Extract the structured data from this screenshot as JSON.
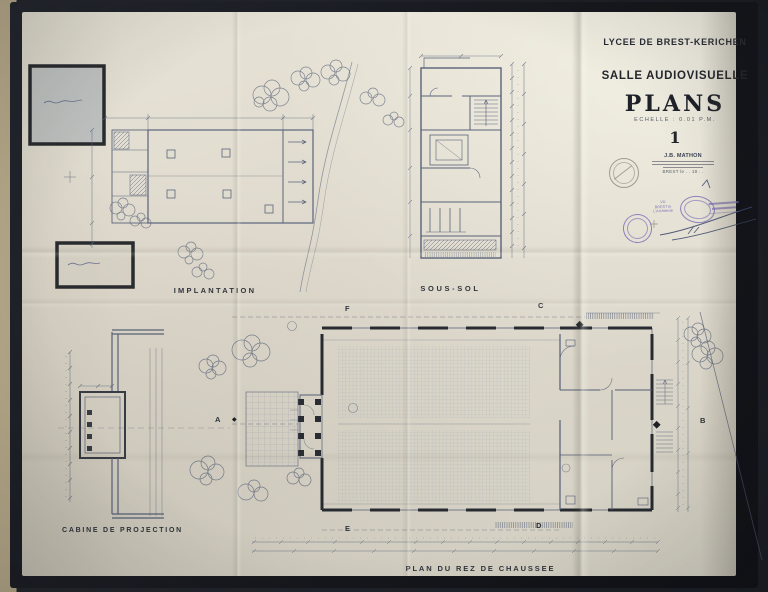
{
  "colors": {
    "table": "#b3a687",
    "sheet_border": "#1a1d23",
    "paper": "#ded9cc",
    "ink": "#4d5872",
    "heavy_ink": "#20242c",
    "stamp_purple": "#7468b4"
  },
  "title_block": {
    "school": "LYCEE DE BREST-KERICHEN",
    "room": "SALLE AUDIOVISUELLE",
    "title": "PLANS",
    "scale": "ECHELLE : 0.01 P.M.",
    "sheet_number": "1",
    "architect_name": "J.B. MATHON",
    "date_line": "BREST le . . 19 . ."
  },
  "stamps": {
    "vu_line1": "VU",
    "vu_line2": "BREST le",
    "vu_line3": "L'Architecte"
  },
  "plan_labels": {
    "implantation": "IMPLANTATION",
    "sous_sol": "SOUS-SOL",
    "cabine": "CABINE DE PROJECTION",
    "rez_de_chaussee": "PLAN DU REZ DE CHAUSSEE"
  },
  "section_markers": {
    "a": "A",
    "b": "B",
    "c": "C",
    "d": "D",
    "e": "E",
    "f": "F",
    "diamond": "◆"
  }
}
